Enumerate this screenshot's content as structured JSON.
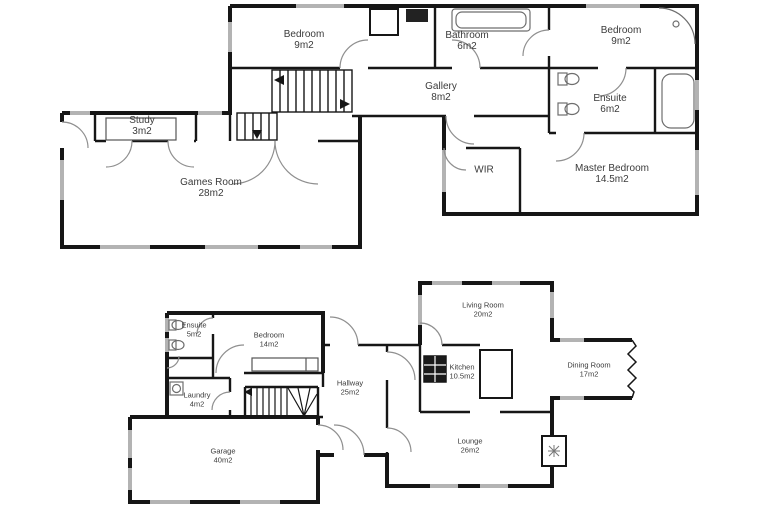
{
  "document": {
    "type": "floor-plan",
    "floor_count": 2
  },
  "colors": {
    "background": "#ffffff",
    "wall": "#161616",
    "window": "#b3b3b3",
    "door_arc": "#8f8f8f",
    "fixture": "#6e6e6e",
    "label_text": "#3b3b3b"
  },
  "floors": {
    "upper": {
      "rooms": [
        {
          "name": "Bedroom",
          "area": "9m2"
        },
        {
          "name": "Bathroom",
          "area": "6m2"
        },
        {
          "name": "Bedroom",
          "area": "9m2"
        },
        {
          "name": "Gallery",
          "area": "8m2"
        },
        {
          "name": "Ensuite",
          "area": "6m2"
        },
        {
          "name": "Study",
          "area": "3m2"
        },
        {
          "name": "Games Room",
          "area": "28m2"
        },
        {
          "name": "WIR",
          "area": ""
        },
        {
          "name": "Master Bedroom",
          "area": "14.5m2"
        }
      ]
    },
    "lower": {
      "rooms": [
        {
          "name": "Ensuite",
          "area": "5m2"
        },
        {
          "name": "Bedroom",
          "area": "14m2"
        },
        {
          "name": "Laundry",
          "area": "4m2"
        },
        {
          "name": "Hallway",
          "area": "25m2"
        },
        {
          "name": "Garage",
          "area": "40m2"
        },
        {
          "name": "Living Room",
          "area": "20m2"
        },
        {
          "name": "Kitchen",
          "area": "10.5m2"
        },
        {
          "name": "Dining Room",
          "area": "17m2"
        },
        {
          "name": "Lounge",
          "area": "26m2"
        }
      ]
    }
  }
}
